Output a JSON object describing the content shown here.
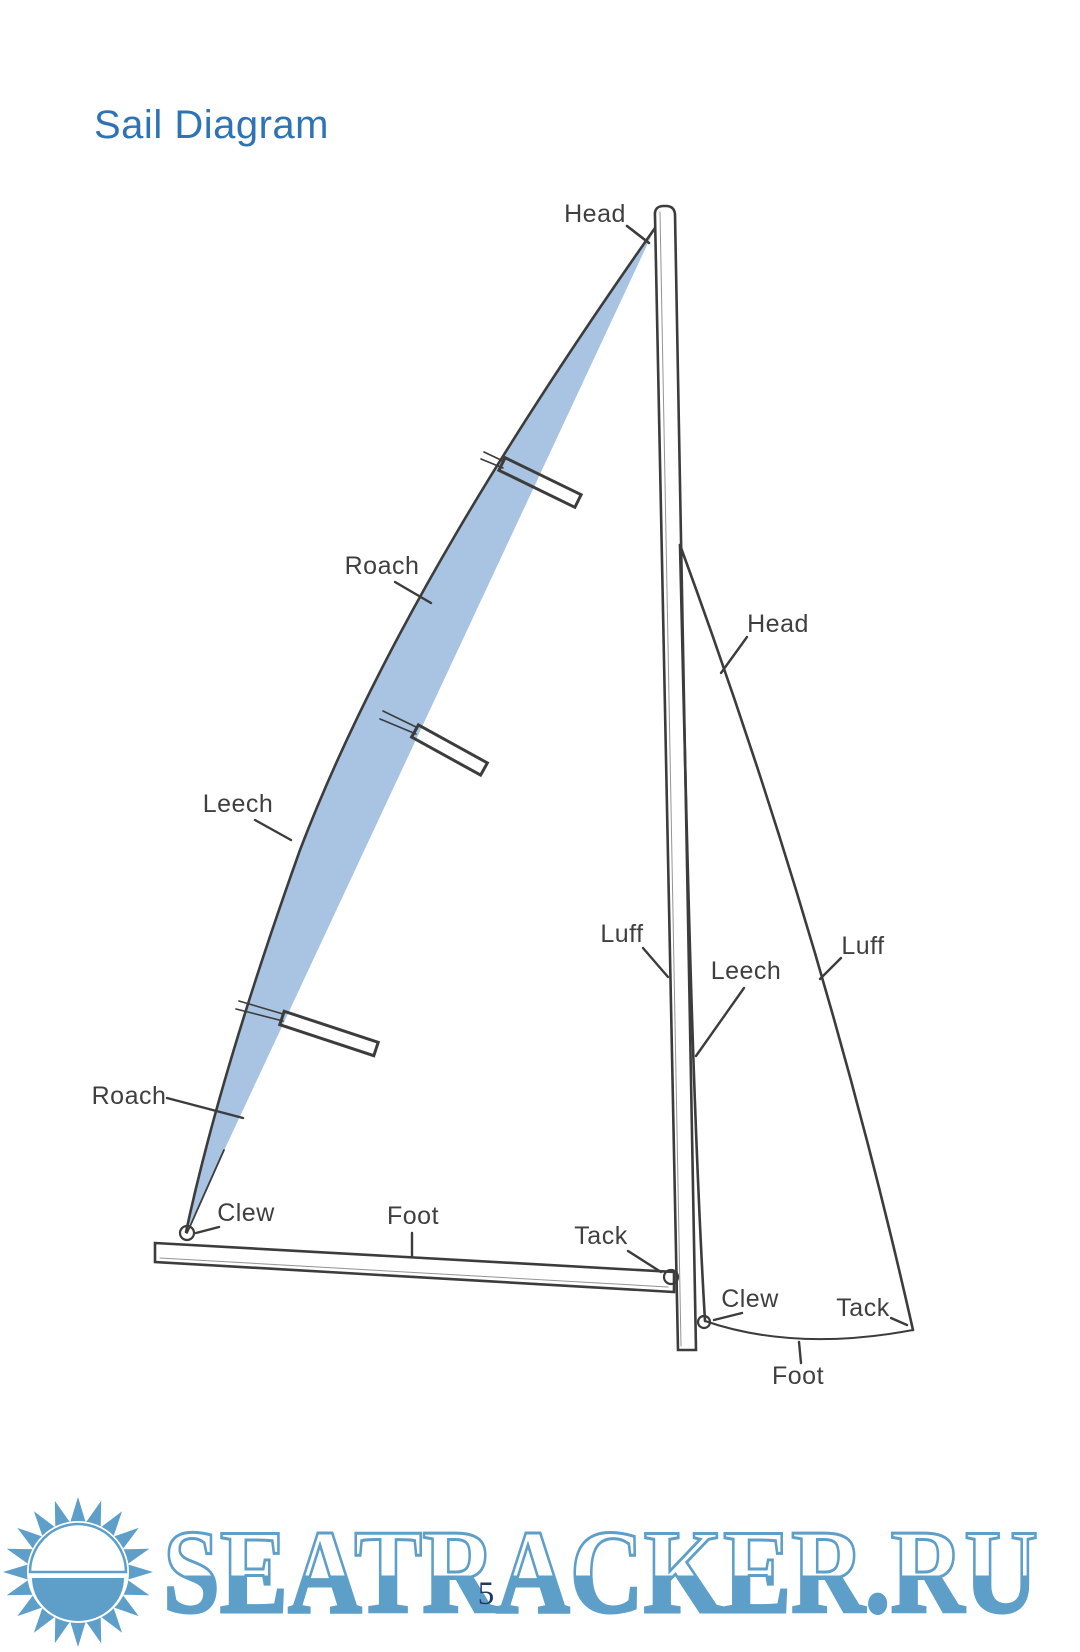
{
  "document": {
    "title": "Sail Diagram",
    "page_number": "5",
    "title_color": "#2e74b5",
    "page_number_color": "#1f3864"
  },
  "diagram": {
    "mainsail_labels": {
      "head": "Head",
      "roach_upper": "Roach",
      "leech": "Leech",
      "roach_lower": "Roach",
      "clew": "Clew",
      "foot": "Foot",
      "tack": "Tack",
      "luff": "Luff"
    },
    "jib_labels": {
      "head": "Head",
      "luff": "Luff",
      "leech": "Leech",
      "clew": "Clew",
      "tack": "Tack",
      "foot": "Foot"
    },
    "colors": {
      "roach_area_fill": "#a9c3e2",
      "sketch_line": "#3c3c3c"
    }
  },
  "watermark": {
    "text": "SEATRACKER.RU",
    "color": "#5d9fc8",
    "logo": "sun-logo"
  }
}
